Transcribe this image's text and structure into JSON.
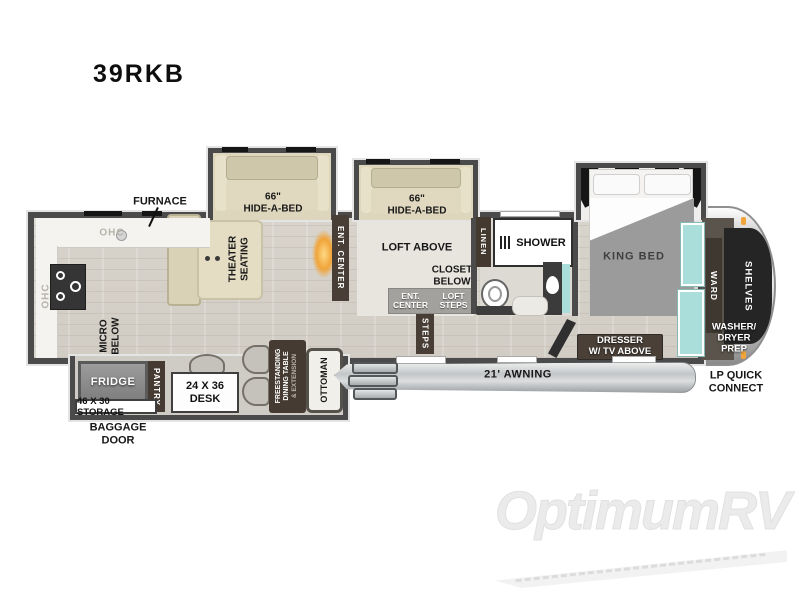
{
  "title": "39RKB",
  "watermark": "OptimumRV",
  "colors": {
    "wall": "#4b4b4b",
    "floor": "#d8d4cc",
    "sofa_tan": "#ddd6bc",
    "dark_strip_brown": "#483e35",
    "teal_accent": "#a9dedb",
    "fireplace_orange": "#f0a43a",
    "awning_gray": "#c7cacc",
    "shelves_black": "#252525",
    "watermark_gray": "#ebebeb"
  },
  "labels": {
    "furnace": "FURNACE",
    "ohc_top": "OHC",
    "ohc_left": "OHC",
    "micro_below": "MICRO\nBELOW",
    "theater_seating": "THEATER\nSEATING",
    "hide_a_bed_living": "66\"\nHIDE-A-BED",
    "ent_center_living": "ENT. CENTER",
    "hide_a_bed_loft": "66\"\nHIDE-A-BED",
    "loft_above": "LOFT ABOVE",
    "closet_below": "CLOSET\nBELOW",
    "ent_center_loft": "ENT.\nCENTER",
    "loft_steps": "LOFT\nSTEPS",
    "steps": "STEPS",
    "linen": "LINEN",
    "shower": "SHOWER",
    "king_bed": "KING BED",
    "dresser": "DRESSER\nW/ TV ABOVE",
    "ward": "WARD",
    "shelves": "SHELVES",
    "washer_dryer_prep": "WASHER/\nDRYER\nPREP",
    "lp_quick_connect": "LP QUICK\nCONNECT",
    "awning": "21' AWNING",
    "fridge": "FRIDGE",
    "pantry": "PANTRY",
    "storage": "46 X 30 STORAGE",
    "baggage_door": "BAGGAGE\nDOOR",
    "desk": "24 X 36\nDESK",
    "dining_table": "FREESTANDING\nDINING TABLE",
    "dining_table_sub": "& EXTENSION",
    "ottoman": "OTTOMAN"
  }
}
